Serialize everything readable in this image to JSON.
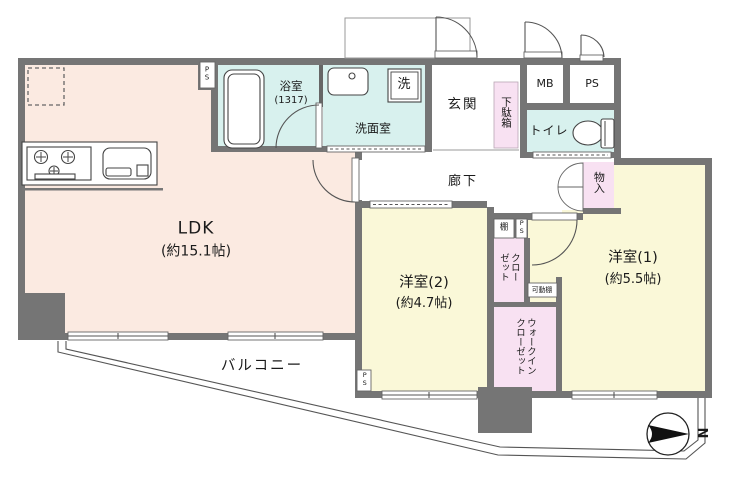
{
  "rooms": {
    "ldk": {
      "label": "LDK",
      "size": "(約15.1帖)"
    },
    "bedroom2": {
      "label": "洋室(2)",
      "size": "(約4.7帖)"
    },
    "bedroom1": {
      "label": "洋室(1)",
      "size": "(約5.5帖)"
    },
    "bath": {
      "label": "浴室",
      "size": "(1317)"
    },
    "washroom": {
      "label": "洗面室"
    },
    "entrance": {
      "label": "玄関"
    },
    "corridor": {
      "label": "廊下"
    },
    "toilet": {
      "label": "トイレ"
    },
    "balcony": {
      "label": "バルコニー"
    }
  },
  "storage": {
    "shoe_box": "下駄箱",
    "storage_closet": "物入",
    "shelf": "棚",
    "closet": "クローゼット",
    "movable_shelf": "可動棚",
    "walk_in_closet": "ウォークインクローゼット"
  },
  "fixtures": {
    "washing_machine": "洗",
    "meter_box": "MB",
    "pipe_space": "PS"
  },
  "compass": {
    "north": "N"
  },
  "colors": {
    "wall": "#757575",
    "ldk": "#fbeae1",
    "room": "#faf8d8",
    "wet": "#d8f1ee",
    "closet": "#f8e1f2"
  }
}
